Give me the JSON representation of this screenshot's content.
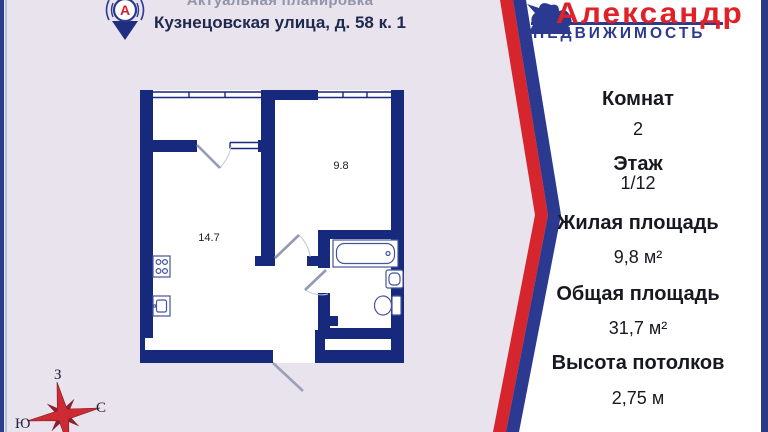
{
  "header": {
    "line1": "Актуальная планировка",
    "line2": "Кузнецовская улица, д. 58 к. 1",
    "pin_letter": "А"
  },
  "agency": {
    "name": "Александр",
    "subtitle": "НЕДВИЖИМОСТЬ"
  },
  "panel": {
    "details": [
      {
        "label": "Комнат",
        "value": "2"
      },
      {
        "label": "Этаж",
        "value": "1/12"
      },
      {
        "label": "Жилая площадь",
        "value": "9,8 м²"
      },
      {
        "label": "Общая площадь",
        "value": "31,7 м²"
      },
      {
        "label": "Высота потолков",
        "value": "2,75 м"
      }
    ]
  },
  "floor_plan": {
    "room_areas": {
      "kitchen_living": "14.7",
      "bedroom": "9.8"
    },
    "features": [
      "balcony",
      "hallway",
      "bathroom",
      "closet",
      "entrance-door"
    ]
  },
  "compass": {
    "west": "З",
    "north": "С",
    "south": "Ю"
  },
  "icons": [
    "location-pin-icon",
    "horseman-statue-icon",
    "compass-rose-icon",
    "stove-icon",
    "kitchen-sink-icon",
    "bathtub-icon",
    "wash-basin-icon",
    "toilet-icon",
    "door-swing-icon"
  ],
  "palette": {
    "background": "#e8e3ed",
    "wall_navy": "#16297d",
    "brand_red": "#e02128",
    "brand_blue": "#2b3990",
    "stripe_red": "#d6252c",
    "header_text": "#20294e",
    "panel_text": "#181820",
    "compass_red": "#ce2a33"
  }
}
